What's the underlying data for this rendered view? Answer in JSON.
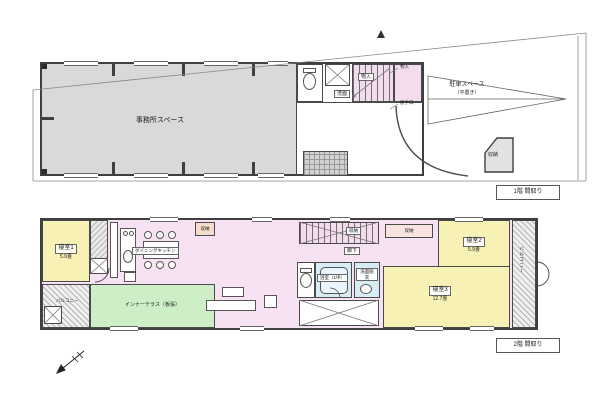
{
  "floor1": {
    "office_label": "事務所スペース",
    "parking_label": "駐車スペース",
    "parking_sub": "（平置き）",
    "storage_label": "収納",
    "closet_label": "物入",
    "wash_label": "洗面",
    "note_top": "物入",
    "note_bottom": "勝手口",
    "caption": "1階 間取り"
  },
  "floor2": {
    "bedroom1": {
      "name": "寝室1",
      "size": "5.9畳"
    },
    "bedroom2": {
      "name": "寝室2",
      "size": "5.9畳"
    },
    "bedroom3": {
      "name": "寝室3",
      "size": "12.7畳"
    },
    "dining_label": "ダイニングキッチン",
    "terrace_label": "インナーテラス（板張）",
    "balcony_label": "バルコニー",
    "deck_label": "バルコニー",
    "corridor_label": "廊下",
    "bath_label": "浴室（1坪）",
    "laundry_label": "洗面脱衣",
    "stairs_storage_label": "収納",
    "storage_top_label": "収納",
    "storage_small_label": "収納",
    "caption": "2階 間取り"
  }
}
